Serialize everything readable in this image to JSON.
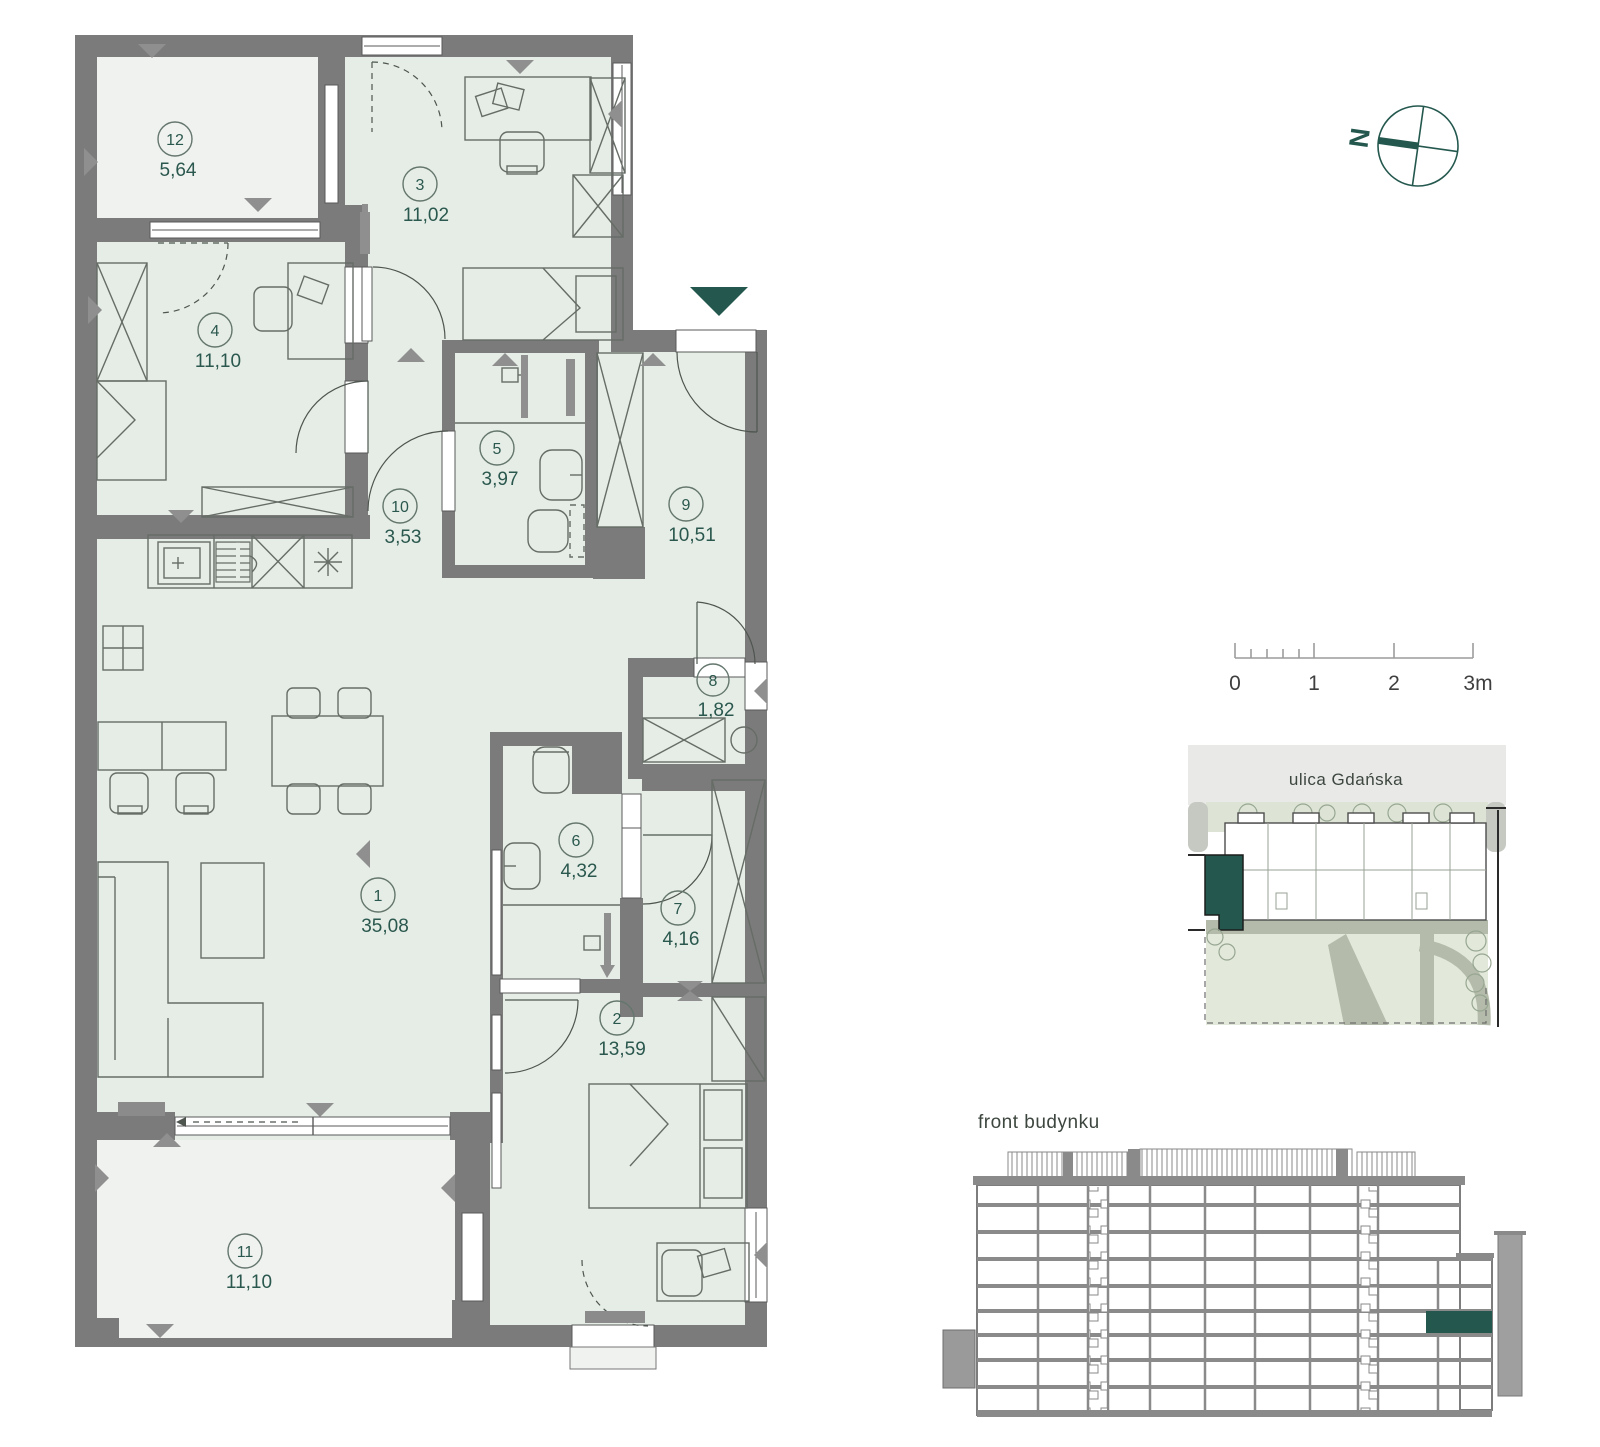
{
  "floorplan": {
    "rooms": [
      {
        "number": "1",
        "area": "35,08"
      },
      {
        "number": "2",
        "area": "13,59"
      },
      {
        "number": "3",
        "area": "11,02"
      },
      {
        "number": "4",
        "area": "11,10"
      },
      {
        "number": "5",
        "area": "3,97"
      },
      {
        "number": "6",
        "area": "4,32"
      },
      {
        "number": "7",
        "area": "4,16"
      },
      {
        "number": "8",
        "area": "1,82"
      },
      {
        "number": "9",
        "area": "10,51"
      },
      {
        "number": "10",
        "area": "3,53"
      },
      {
        "number": "11",
        "area": "11,10"
      },
      {
        "number": "12",
        "area": "5,64"
      }
    ]
  },
  "compass": {
    "north_label": "N"
  },
  "scalebar": {
    "labels": [
      "0",
      "1",
      "2",
      "3m"
    ]
  },
  "siteplan": {
    "street_label": "ulica Gdańska"
  },
  "elevation": {
    "label": "front budynku"
  },
  "colors": {
    "accent_teal": "#24584e",
    "wall_gray": "#7b7b7b",
    "room_fill": "#e5ede6",
    "balcony_fill": "#f0f2ef"
  }
}
